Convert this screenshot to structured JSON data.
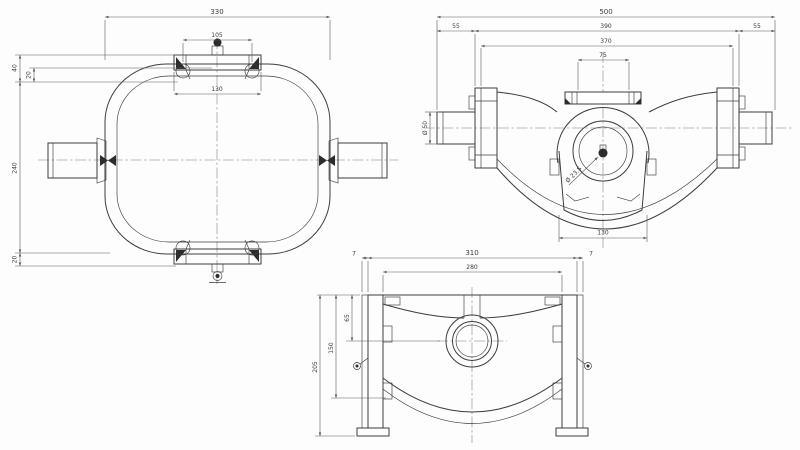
{
  "app": {
    "title": "axle housing technical drawing, three orthographic views"
  },
  "colors": {
    "background": "#fdfdfd",
    "line": "#3d3d3d",
    "dim_line": "#5a5a5a",
    "text": "#3c3c3c"
  },
  "views": {
    "top_view": {
      "label": "plan view of banjo housing",
      "dims": {
        "overall_width": "330",
        "cover_span": "105",
        "bolt_span": "130",
        "cover_offset": "40",
        "cover_step": "20",
        "overall_height": "240",
        "bottom_cover_offset": "20"
      }
    },
    "front_view": {
      "label": "front view of axle assembly",
      "dims": {
        "overall_length": "500",
        "shaft_left": "55",
        "flange_span": "390",
        "shaft_right": "55",
        "inner_flange_span": "370",
        "neck_span": "75",
        "shaft_diameter": "Ø 50",
        "center_bore": "Ø 23.5",
        "bucket_width": "130"
      }
    },
    "side_view": {
      "label": "side view of housing",
      "dims": {
        "lip_left": "7",
        "overall_width": "310",
        "lip_right": "7",
        "inner_span": "280",
        "boss_center": "65",
        "skirt_depth": "150",
        "overall_height": "205"
      }
    }
  }
}
